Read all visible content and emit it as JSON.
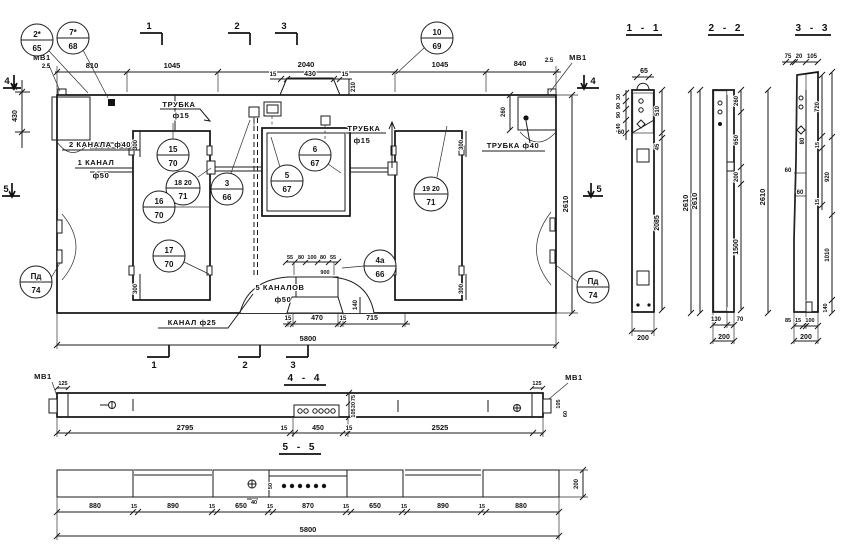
{
  "plan": {
    "labels": {
      "mv1_tl": "МВ1",
      "mv1_tr": "МВ1",
      "trubka15_left_1": "ТРУБКА",
      "trubka15_left_2": "ф15",
      "kanala2": "2 КАНАЛА ф40",
      "kanal1_1": "1 КАНАЛ",
      "kanal1_2": "ф50",
      "trubka15_mid_1": "ТРУБКА",
      "trubka15_mid_2": "ф15",
      "trubka40": "ТРУБКА ф40",
      "kanalov5_1": "5 КАНАЛОВ",
      "kanalov5_2": "ф50",
      "kanal25": "КАНАЛ ф25"
    },
    "dims": {
      "top": [
        "2.5",
        "810",
        "1045",
        "2040",
        "1045",
        "840",
        "2.5"
      ],
      "hump": [
        "15",
        "430",
        "15"
      ],
      "hump_h": "210",
      "left": [
        "35",
        "430"
      ],
      "right_260": "260",
      "height": "2610",
      "open300": "300",
      "chan": [
        "55",
        "80",
        "100",
        "80",
        "55"
      ],
      "chan_w": "900",
      "chan_h": "140",
      "bottom": [
        "15",
        "470",
        "15",
        "715"
      ],
      "total": "5800"
    },
    "callouts": {
      "c2": {
        "t": "2*",
        "b": "65"
      },
      "c7": {
        "t": "7*",
        "b": "68"
      },
      "c10": {
        "t": "10",
        "b": "69"
      },
      "c15": {
        "t": "15",
        "b": "70"
      },
      "c1820": {
        "t": "18 20",
        "b": "71"
      },
      "c3": {
        "t": "3",
        "b": "66"
      },
      "c16": {
        "t": "16",
        "b": "70"
      },
      "c17": {
        "t": "17",
        "b": "70"
      },
      "c5": {
        "t": "5",
        "b": "67"
      },
      "c6": {
        "t": "6",
        "b": "67"
      },
      "c1920": {
        "t": "19 20",
        "b": "71"
      },
      "c4a": {
        "t": "4а",
        "b": "66"
      },
      "cpd_left": {
        "t": "Пд",
        "b": "74"
      },
      "cpd_right": {
        "t": "Пд",
        "b": "74"
      }
    },
    "marks": {
      "m1": "1",
      "m2": "2",
      "m3": "3",
      "m4": "4",
      "m5": "5"
    }
  },
  "sections": {
    "s11": {
      "title": "1 - 1",
      "d65": "65",
      "stack": [
        "30",
        "90",
        "90",
        "140"
      ],
      "d60": "60",
      "d510": "510",
      "d45": "45",
      "d2085": "2085",
      "d2610": "2610",
      "d200": "200"
    },
    "s22": {
      "title": "2 - 2",
      "d260": "260",
      "d650": "650",
      "d200": "200",
      "d1500": "1500",
      "d2610l": "2610",
      "d2610r": "2610",
      "d130": "130",
      "d70": "70",
      "d200b": "200"
    },
    "s33": {
      "title": "3 - 3",
      "top": [
        "75",
        "20",
        "105"
      ],
      "d720": "720",
      "d920": "920",
      "d1010": "1010",
      "d140": "140",
      "d15a": "15",
      "d15b": "15",
      "d80": "80",
      "d60a": "60",
      "d60b": "60",
      "bottom": [
        "85",
        "15",
        "100"
      ],
      "d200": "200"
    },
    "s44": {
      "title": "4 - 4",
      "mv1l": "МВ1",
      "mv1r": "МВ1",
      "d125l": "125",
      "d125r": "125",
      "d2795": "2795",
      "d15a": "15",
      "d450": "450",
      "d15b": "15",
      "d2525": "2525",
      "v": [
        "75",
        "20",
        "105"
      ],
      "r105": "105",
      "r60": "60"
    },
    "s55": {
      "title": "5 - 5",
      "seg": [
        "880",
        "15",
        "890",
        "15",
        "650",
        "15",
        "870",
        "15",
        "650",
        "15",
        "890",
        "15",
        "880"
      ],
      "total": "5800",
      "d200": "200",
      "d40": "40",
      "d50": "50"
    }
  }
}
